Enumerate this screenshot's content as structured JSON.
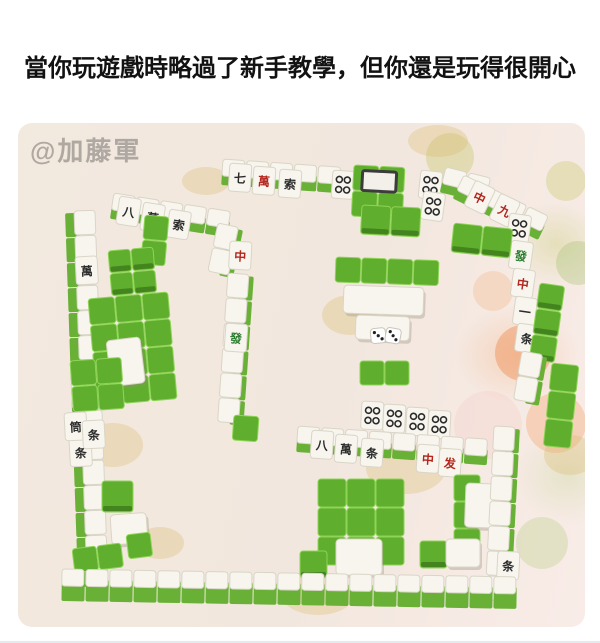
{
  "page": {
    "caption": "當你玩遊戲時略過了新手教學，但你還是玩得很開心",
    "background": "#ffffff"
  },
  "photo": {
    "watermark": "@加藤軍",
    "subject": "mahjong-tile-maze-on-carpet",
    "colors": {
      "green": "#5fae2e",
      "green_hi": "#8fd457",
      "green_dark": "#4b9226",
      "green_side": "#69b037",
      "green_shadow": "rgba(40,90,15,0.5)",
      "tile_white": "#f7f5ee",
      "tile_edge": "#d9d5c7",
      "tile_shadow": "rgba(150,140,120,0.35)",
      "glyph_black": "#2b2b2b",
      "glyph_red": "#b3261e",
      "glyph_green": "#2e7d32",
      "carpet": "#f2e9df",
      "floral_orange": "rgba(240,150,95,0.5)",
      "stain_yellow": "rgba(219,188,108,0.32)"
    },
    "floral": [
      {
        "x": 505,
        "y": 230,
        "r": 28,
        "c": "rgba(240,150,95,0.50)",
        "o": 1
      },
      {
        "x": 538,
        "y": 300,
        "r": 30,
        "c": "rgba(244,178,130,0.45)",
        "o": 1
      },
      {
        "x": 475,
        "y": 168,
        "r": 20,
        "c": "rgba(246,190,150,0.40)",
        "o": 1
      },
      {
        "x": 432,
        "y": 34,
        "r": 24,
        "c": "rgba(200,200,110,0.40)",
        "o": 1
      },
      {
        "x": 548,
        "y": 58,
        "r": 20,
        "c": "rgba(205,205,120,0.40)",
        "o": 1
      },
      {
        "x": 560,
        "y": 140,
        "r": 22,
        "c": "rgba(175,198,125,0.40)",
        "o": 1
      },
      {
        "x": 524,
        "y": 420,
        "r": 26,
        "c": "rgba(185,205,135,0.35)",
        "o": 1
      },
      {
        "x": 470,
        "y": 302,
        "r": 34,
        "c": "rgba(245,205,200,0.35)",
        "o": 1
      }
    ],
    "stains": [
      {
        "x": 95,
        "y": 322,
        "rx": 30,
        "ry": 22
      },
      {
        "x": 388,
        "y": 345,
        "rx": 40,
        "ry": 26
      },
      {
        "x": 332,
        "y": 192,
        "rx": 28,
        "ry": 20
      },
      {
        "x": 300,
        "y": 472,
        "rx": 36,
        "ry": 20
      },
      {
        "x": 142,
        "y": 420,
        "rx": 24,
        "ry": 16
      },
      {
        "x": 552,
        "y": 332,
        "rx": 26,
        "ry": 20
      },
      {
        "x": 420,
        "y": 18,
        "rx": 30,
        "ry": 16
      },
      {
        "x": 188,
        "y": 58,
        "rx": 24,
        "ry": 14
      }
    ],
    "elements": [
      {
        "t": "hwall",
        "x": 96,
        "y": 70,
        "n": 5,
        "rot": 9
      },
      {
        "t": "futile",
        "x": 102,
        "y": 73,
        "ch": "八",
        "c": "#2b2b2b",
        "rot": 9
      },
      {
        "t": "futile",
        "x": 126,
        "y": 79,
        "ch": "萬",
        "c": "#2b2b2b",
        "rot": 9
      },
      {
        "t": "futile",
        "x": 152,
        "y": 86,
        "ch": "索",
        "c": "#2b2b2b",
        "rot": 9
      },
      {
        "t": "vwall",
        "x": 56,
        "y": 88,
        "n": 15,
        "rot": -2,
        "side": "left"
      },
      {
        "t": "futile",
        "x": 57,
        "y": 134,
        "ch": "萬",
        "c": "#2b2b2b",
        "rot": -3
      },
      {
        "t": "futile",
        "x": 53,
        "y": 258,
        "ch": "筒",
        "c": "#2b2b2b",
        "rot": -3
      },
      {
        "t": "futile",
        "x": 51,
        "y": 316,
        "ch": "条",
        "c": "#2b2b2b",
        "rot": -3
      },
      {
        "t": "vwall",
        "x": 200,
        "y": 100,
        "n": 2,
        "rot": 12,
        "side": "right"
      },
      {
        "t": "hwall",
        "x": 205,
        "y": 36,
        "n": 5,
        "rot": 4
      },
      {
        "t": "futile",
        "x": 212,
        "y": 40,
        "ch": "七",
        "c": "#2b2b2b",
        "rot": 4
      },
      {
        "t": "futile",
        "x": 236,
        "y": 43,
        "ch": "萬",
        "c": "#b3261e",
        "rot": 4
      },
      {
        "t": "futile",
        "x": 262,
        "y": 46,
        "ch": "索",
        "c": "#2b2b2b",
        "rot": 4
      },
      {
        "t": "dots",
        "x": 315,
        "y": 47,
        "rot": 4
      },
      {
        "t": "table",
        "x": 336,
        "y": 42,
        "rot": 3
      },
      {
        "t": "dots",
        "x": 403,
        "y": 47,
        "rot": 6
      },
      {
        "t": "dots",
        "x": 406,
        "y": 68,
        "rot": 8
      },
      {
        "t": "hwall",
        "x": 428,
        "y": 44,
        "n": 2,
        "rot": 14
      },
      {
        "t": "hwall",
        "x": 446,
        "y": 52,
        "n": 4,
        "rot": 26
      },
      {
        "t": "futile",
        "x": 458,
        "y": 57,
        "ch": "中",
        "c": "#b3261e",
        "rot": 26
      },
      {
        "t": "futile",
        "x": 483,
        "y": 70,
        "ch": "九",
        "c": "#b3261e",
        "rot": 26
      },
      {
        "t": "dots",
        "x": 492,
        "y": 90,
        "rot": 8
      },
      {
        "t": "futile",
        "x": 494,
        "y": 117,
        "ch": "發",
        "c": "#2e7d32",
        "rot": 8
      },
      {
        "t": "futile",
        "x": 496,
        "y": 145,
        "ch": "中",
        "c": "#b3261e",
        "rot": 8
      },
      {
        "t": "futile",
        "x": 498,
        "y": 173,
        "ch": "一",
        "c": "#2b2b2b",
        "rot": 8
      },
      {
        "t": "futile",
        "x": 500,
        "y": 200,
        "ch": "条",
        "c": "#2b2b2b",
        "rot": 8
      },
      {
        "t": "gflat",
        "x": 522,
        "y": 160,
        "cols": 1,
        "rows": 3,
        "cell": 26,
        "cube": true,
        "rot": 8
      },
      {
        "t": "gflat",
        "x": 534,
        "y": 240,
        "cols": 1,
        "rows": 3,
        "cell": 28,
        "rot": 6
      },
      {
        "t": "vwall",
        "x": 504,
        "y": 228,
        "n": 2,
        "rot": 10,
        "side": "right"
      },
      {
        "t": "gflat",
        "x": 127,
        "y": 92,
        "cols": 1,
        "rows": 2,
        "cell": 25,
        "rot": 5
      },
      {
        "t": "gflat",
        "x": 90,
        "y": 128,
        "cols": 2,
        "rows": 2,
        "cell": 23,
        "cube": true,
        "rot": -5
      },
      {
        "t": "gflat",
        "x": 70,
        "y": 176,
        "cols": 3,
        "rows": 4,
        "cell": 27,
        "rot": -5
      },
      {
        "t": "wtile",
        "x": 88,
        "y": 218,
        "w": 34,
        "h": 46,
        "rot": -7
      },
      {
        "t": "gflat",
        "x": 52,
        "y": 238,
        "cols": 2,
        "rows": 2,
        "cell": 26,
        "rot": -4
      },
      {
        "t": "gflat",
        "x": 344,
        "y": 82,
        "cols": 2,
        "rows": 1,
        "cell": 30,
        "cube": true,
        "rot": 3
      },
      {
        "t": "gflat",
        "x": 436,
        "y": 100,
        "cols": 2,
        "rows": 1,
        "cell": 30,
        "cube": true,
        "rot": 6
      },
      {
        "t": "futile",
        "x": 212,
        "y": 118,
        "ch": "中",
        "c": "#b3261e",
        "rot": 3
      },
      {
        "t": "vwall",
        "x": 210,
        "y": 150,
        "n": 6,
        "rot": 4,
        "side": "right"
      },
      {
        "t": "futile",
        "x": 208,
        "y": 200,
        "ch": "發",
        "c": "#2e7d32",
        "rot": 4
      },
      {
        "t": "gflat",
        "x": 216,
        "y": 292,
        "cols": 1,
        "rows": 1,
        "cell": 26,
        "rot": 4
      },
      {
        "t": "gflat",
        "x": 318,
        "y": 134,
        "cols": 4,
        "rows": 1,
        "cell": 26,
        "rot": 2
      },
      {
        "t": "wtile",
        "x": 326,
        "y": 162,
        "w": 80,
        "h": 28,
        "rot": 2
      },
      {
        "t": "wtile",
        "x": 338,
        "y": 192,
        "w": 54,
        "h": 24,
        "rot": 2
      },
      {
        "t": "dice",
        "x": 352,
        "y": 206,
        "rot": -6
      },
      {
        "t": "dice",
        "x": 369,
        "y": 204,
        "rot": 10
      },
      {
        "t": "gflat",
        "x": 342,
        "y": 238,
        "cols": 2,
        "rows": 1,
        "cell": 25,
        "rot": 0
      },
      {
        "t": "dots",
        "x": 344,
        "y": 278,
        "rot": 3
      },
      {
        "t": "dots",
        "x": 366,
        "y": 281,
        "rot": 3
      },
      {
        "t": "dots",
        "x": 389,
        "y": 284,
        "rot": 3
      },
      {
        "t": "dots",
        "x": 411,
        "y": 287,
        "rot": 3
      },
      {
        "t": "hwall",
        "x": 280,
        "y": 303,
        "n": 8,
        "rot": 4
      },
      {
        "t": "futile",
        "x": 294,
        "y": 307,
        "ch": "八",
        "c": "#2b2b2b",
        "rot": 4
      },
      {
        "t": "futile",
        "x": 318,
        "y": 311,
        "ch": "萬",
        "c": "#2b2b2b",
        "rot": 4
      },
      {
        "t": "futile",
        "x": 344,
        "y": 315,
        "ch": "条",
        "c": "#2b2b2b",
        "rot": 4
      },
      {
        "t": "futile",
        "x": 400,
        "y": 321,
        "ch": "中",
        "c": "#b3261e",
        "rot": 4
      },
      {
        "t": "futile",
        "x": 422,
        "y": 325,
        "ch": "发",
        "c": "#b3261e",
        "rot": 4
      },
      {
        "t": "gflat",
        "x": 84,
        "y": 358,
        "cols": 1,
        "rows": 1,
        "cell": 32,
        "cube": true,
        "rot": 0
      },
      {
        "t": "wtile",
        "x": 92,
        "y": 392,
        "w": 36,
        "h": 30,
        "rot": -4
      },
      {
        "t": "futile",
        "x": 46,
        "y": 290,
        "ch": "筒",
        "c": "#2b2b2b",
        "rot": -3
      },
      {
        "t": "futile",
        "x": 64,
        "y": 298,
        "ch": "条",
        "c": "#2b2b2b",
        "rot": -3
      },
      {
        "t": "gflat",
        "x": 54,
        "y": 426,
        "cols": 2,
        "rows": 1,
        "cell": 25,
        "rot": -7
      },
      {
        "t": "gflat",
        "x": 108,
        "y": 412,
        "cols": 1,
        "rows": 1,
        "cell": 25,
        "rot": -7
      },
      {
        "t": "gflat",
        "x": 300,
        "y": 356,
        "cols": 3,
        "rows": 3,
        "cell": 29,
        "rot": 0
      },
      {
        "t": "wtile",
        "x": 318,
        "y": 416,
        "w": 46,
        "h": 36,
        "rot": 0
      },
      {
        "t": "gflat",
        "x": 436,
        "y": 352,
        "cols": 1,
        "rows": 3,
        "cell": 27,
        "rot": 0
      },
      {
        "t": "wtile",
        "x": 448,
        "y": 360,
        "w": 30,
        "h": 44,
        "rot": 2
      },
      {
        "t": "vwall",
        "x": 476,
        "y": 303,
        "n": 7,
        "rot": 3,
        "side": "right"
      },
      {
        "t": "futile",
        "x": 480,
        "y": 428,
        "ch": "条",
        "c": "#2b2b2b",
        "rot": 3
      },
      {
        "t": "gflat",
        "x": 282,
        "y": 428,
        "cols": 1,
        "rows": 1,
        "cell": 28,
        "cube": true,
        "rot": 0
      },
      {
        "t": "gflat",
        "x": 402,
        "y": 418,
        "cols": 1,
        "rows": 1,
        "cell": 28,
        "cube": true,
        "rot": 0
      },
      {
        "t": "wtile",
        "x": 428,
        "y": 416,
        "w": 34,
        "h": 28,
        "rot": 0
      },
      {
        "t": "hwall",
        "x": 44,
        "y": 446,
        "n": 19,
        "rot": 1,
        "gh": 22
      }
    ]
  }
}
